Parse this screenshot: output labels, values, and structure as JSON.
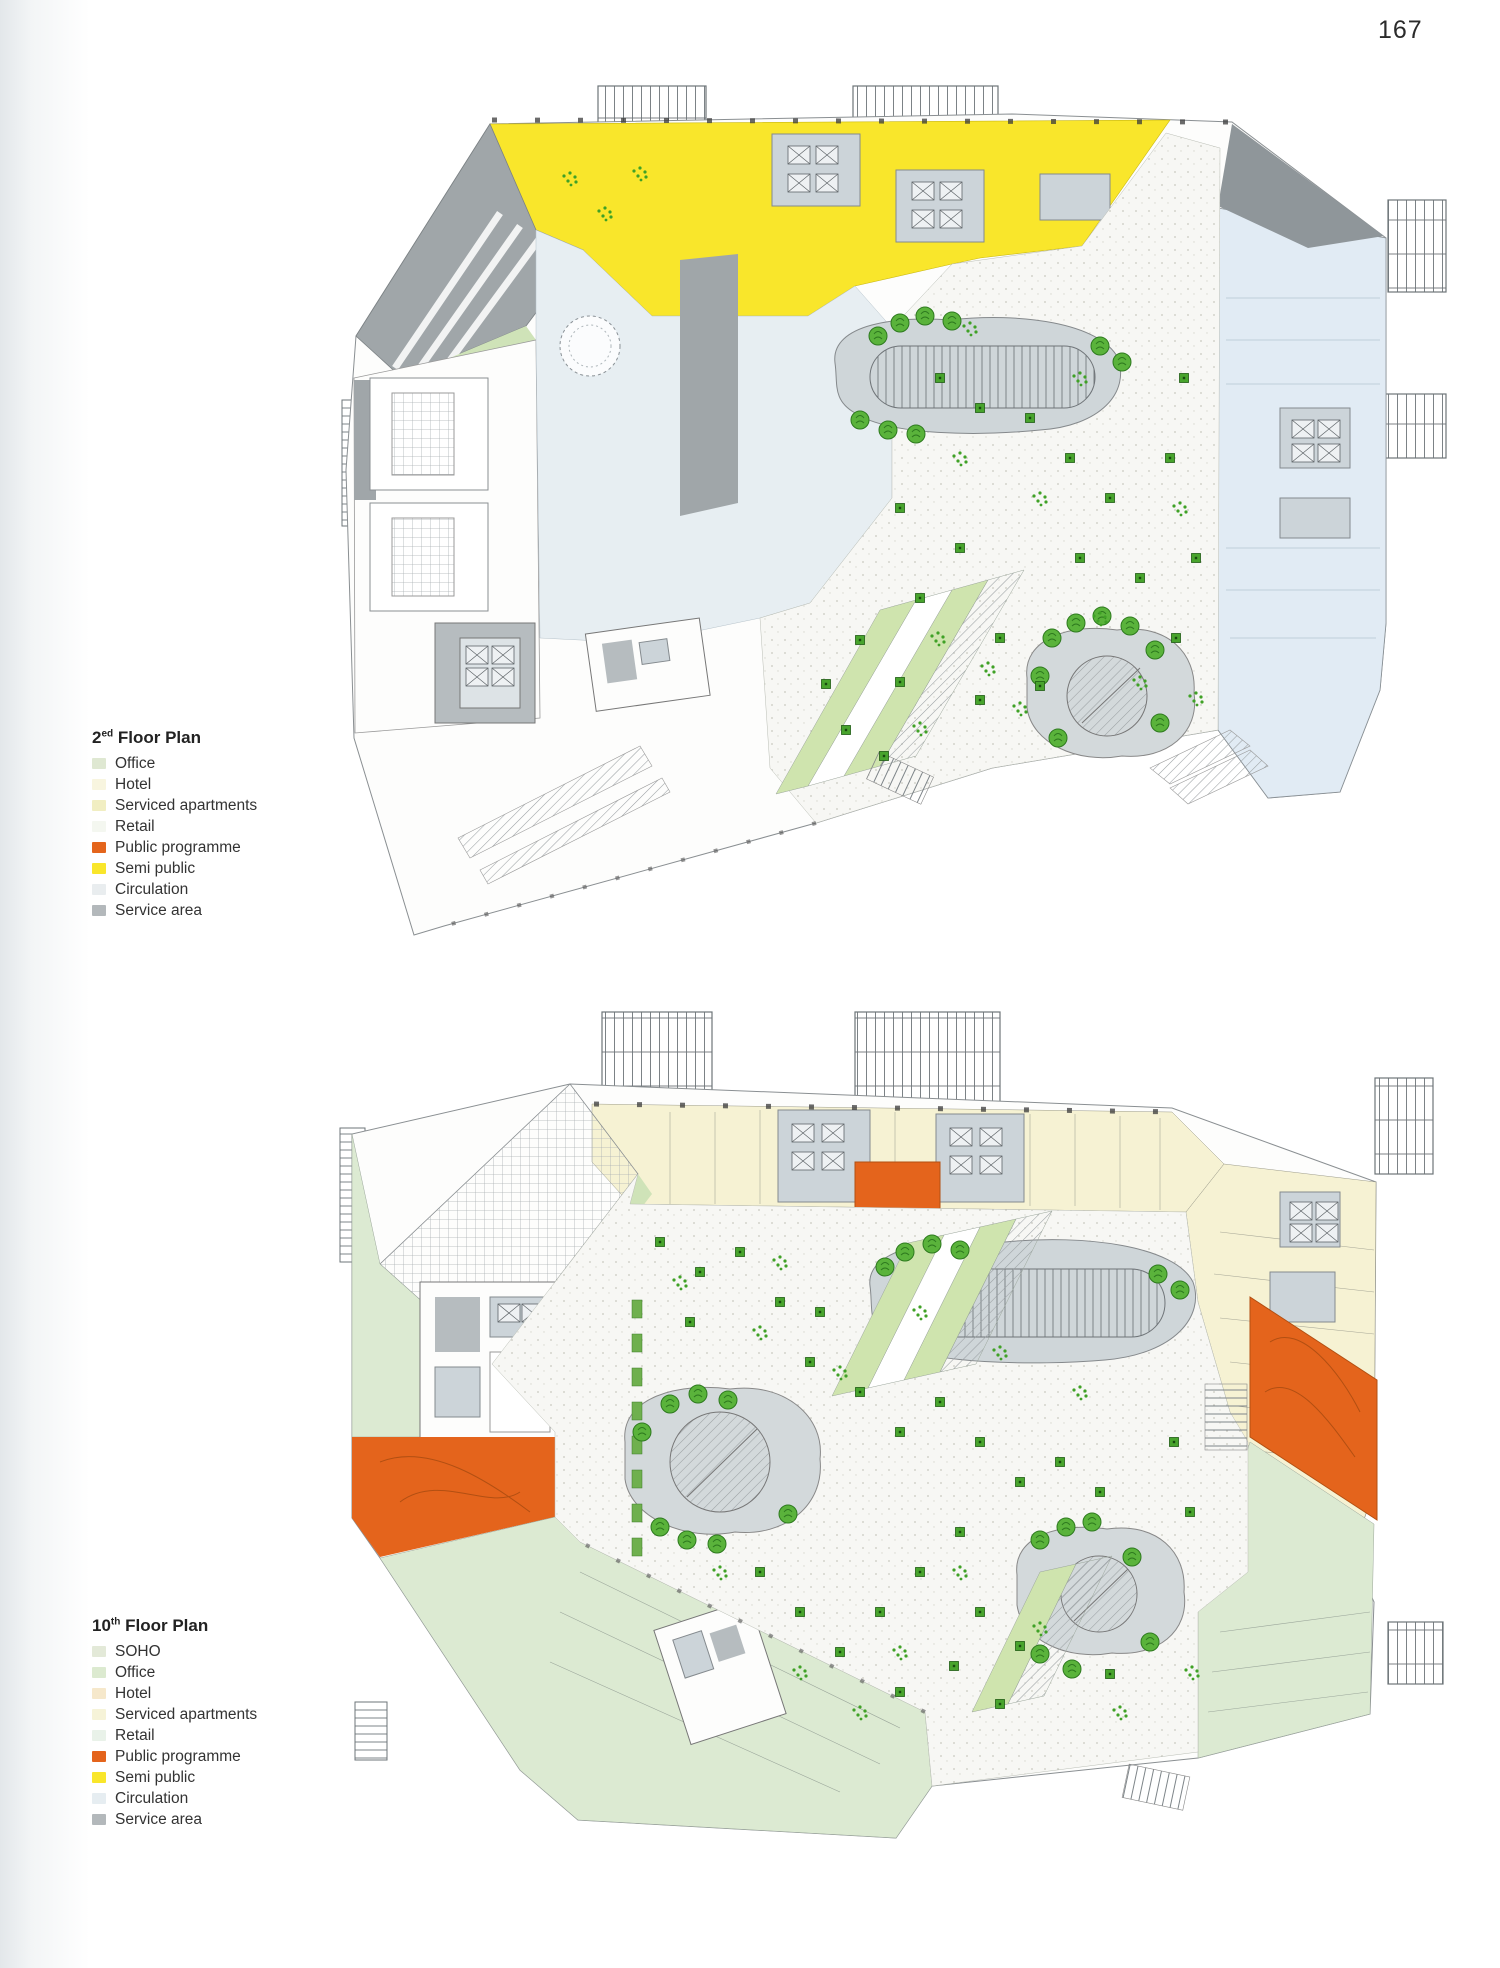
{
  "page": {
    "number": "167"
  },
  "plan1": {
    "title": {
      "base": "2",
      "sup": "ed",
      "rest": " Floor Plan"
    },
    "legend": [
      {
        "label": "Office",
        "color": "#dfe8d2"
      },
      {
        "label": "Hotel",
        "color": "#f8f5df"
      },
      {
        "label": "Serviced apartments",
        "color": "#f1eec2"
      },
      {
        "label": "Retail",
        "color": "#f4f7f0"
      },
      {
        "label": "Public programme",
        "color": "#e4651c"
      },
      {
        "label": "Semi public",
        "color": "#f9e62b"
      },
      {
        "label": "Circulation",
        "color": "#e9edef"
      },
      {
        "label": "Service area",
        "color": "#b3b8bb"
      }
    ]
  },
  "plan2": {
    "title": {
      "base": "10",
      "sup": "th",
      "rest": " Floor Plan"
    },
    "legend": [
      {
        "label": "SOHO",
        "color": "#e3e9d8"
      },
      {
        "label": "Office",
        "color": "#dcead0"
      },
      {
        "label": "Hotel",
        "color": "#f6e8cb"
      },
      {
        "label": "Serviced apartments",
        "color": "#f6f3d8"
      },
      {
        "label": "Retail",
        "color": "#e9f2e9"
      },
      {
        "label": "Public programme",
        "color": "#e4641c"
      },
      {
        "label": "Semi public",
        "color": "#f9e62b"
      },
      {
        "label": "Circulation",
        "color": "#e6edf1"
      },
      {
        "label": "Service area",
        "color": "#b3b8bb"
      }
    ]
  },
  "drawing_colors": {
    "semi_public_yellow": "#f9e62b",
    "public_orange": "#e4641c",
    "cream": "#f6f2d3",
    "pale_green": "#dcead2",
    "circulation_blue": "#e7eef2",
    "right_band_blue": "#e1ebf4",
    "service_gray": "#a0a6a9",
    "core_gray": "#ccd4d9",
    "plaza_gray": "#cfd6d9",
    "stipple_base": "#f7f7f4",
    "tree_green": "#5ab33b",
    "shrub_green": "#48a42d"
  }
}
